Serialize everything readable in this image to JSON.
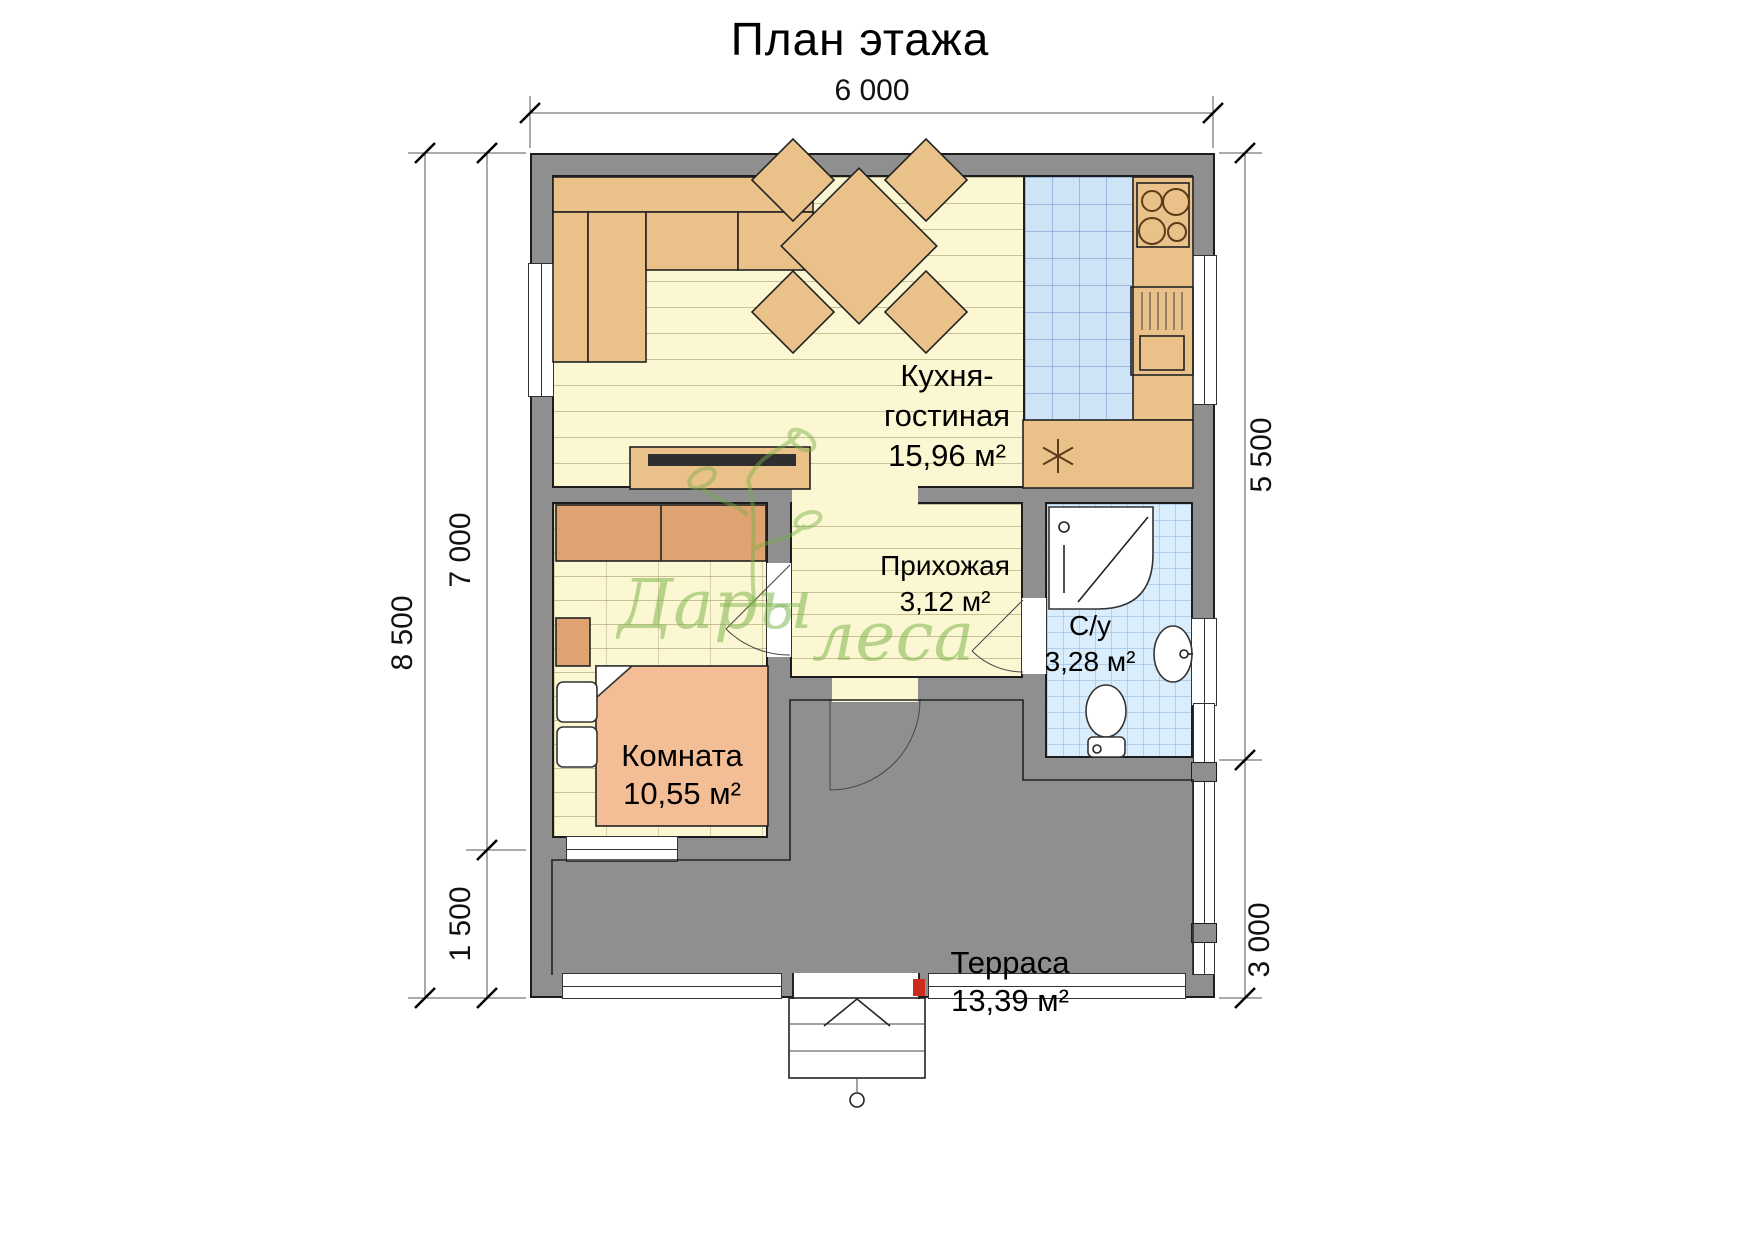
{
  "title": "План этажа",
  "watermark": {
    "word1": "Дары",
    "word2": "леса"
  },
  "dimensions": {
    "top": "6 000",
    "left_outer": "8 500",
    "left_inner": "7 000",
    "left_terrace": "1 500",
    "right_upper": "5 500",
    "right_lower": "3 000"
  },
  "rooms": {
    "kitchen_living": {
      "name_line1": "Кухня-",
      "name_line2": "гостиная",
      "area": "15,96 м²"
    },
    "hallway": {
      "name": "Прихожая",
      "area": "3,12 м²"
    },
    "bathroom": {
      "name": "С/у",
      "area": "3,28 м²"
    },
    "bedroom": {
      "name": "Комната",
      "area": "10,55 м²"
    },
    "terrace": {
      "name": "Терраса",
      "area": "13,39 м²"
    }
  },
  "colors": {
    "wall": "#8f8f8f",
    "floor": "#fbf7d2",
    "tile_kitchen": "#cfe3f7",
    "tile_bath": "#d9edfc",
    "terrace": "#ebcf9f",
    "furniture_tan": "#eac189",
    "furniture_orange": "#dfa271",
    "bed_peach": "#f3bd96",
    "watermark_green": "#76b043",
    "accent_red": "#cc2b1d"
  }
}
